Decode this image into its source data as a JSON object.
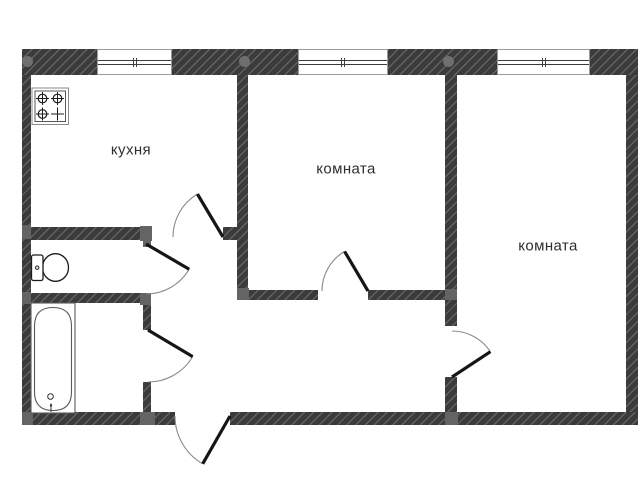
{
  "rooms": [
    {
      "name": "kitchen",
      "label": "кухня"
    },
    {
      "name": "room-1",
      "label": "комната"
    },
    {
      "name": "room-2",
      "label": "комната"
    }
  ],
  "fixtures": [
    {
      "name": "stove-icon"
    },
    {
      "name": "toilet-icon"
    },
    {
      "name": "bathtub-icon"
    }
  ],
  "colors": {
    "wall": "#3b3b3b",
    "wall_hatch": "#5f5f5f",
    "junction_cap": "#646464",
    "door_leaf": "#161616",
    "door_arc": "#8a8a8a",
    "label_text": "#2e2e2e",
    "background": "#ffffff"
  }
}
